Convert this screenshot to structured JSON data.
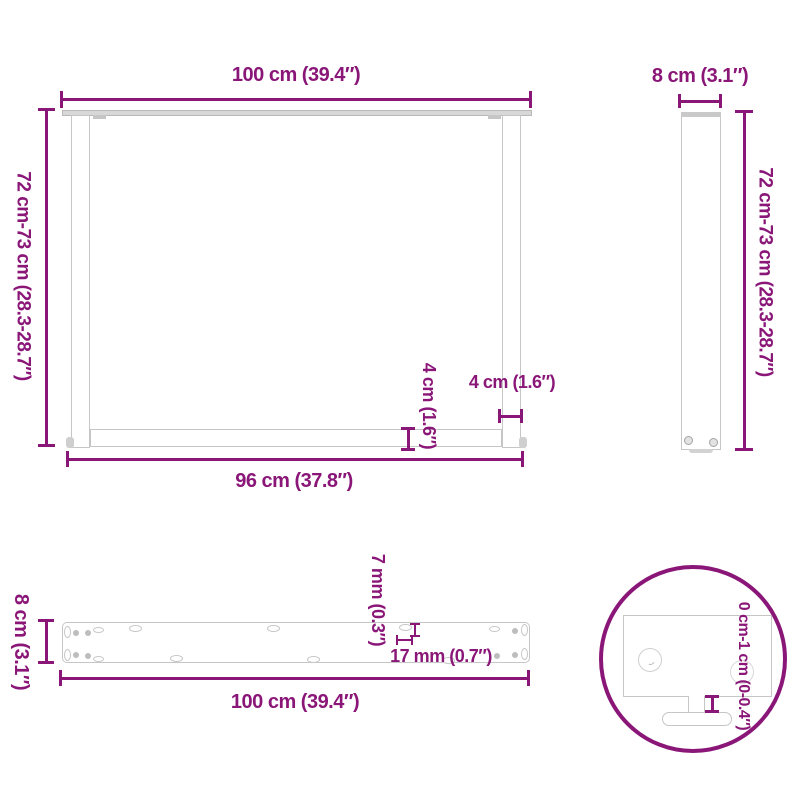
{
  "title": "Table legs dimension diagram",
  "accent_color": "#8A1778",
  "outline_color": "#C6C6C6",
  "views": {
    "front": {
      "name": "front-view-u-shaped-legs-pair",
      "labels": {
        "width": "100 cm (39.4″)",
        "height": "72 cm-73 cm (28.3-28.7″)",
        "inner_width": "96 cm (37.8″)",
        "crossbar_height": "4 cm (1.6″)",
        "leg_width": "4 cm (1.6″)"
      }
    },
    "side": {
      "name": "side-view-single-leg",
      "labels": {
        "depth": "8 cm (3.1″)",
        "height": "72 cm-73 cm (28.3-28.7″)"
      }
    },
    "mounting_bar": {
      "name": "top-view-mounting-bar",
      "labels": {
        "width": "8 cm (3.1″)",
        "length": "100 cm (39.4″)",
        "slot_width": "7 mm (0.3″)",
        "slot_length": "17 mm (0.7″)"
      }
    },
    "foot_detail": {
      "name": "detail-adjustable-foot",
      "labels": {
        "adjustment_range": "0 cm-1 cm (0-0.4″)"
      }
    }
  }
}
